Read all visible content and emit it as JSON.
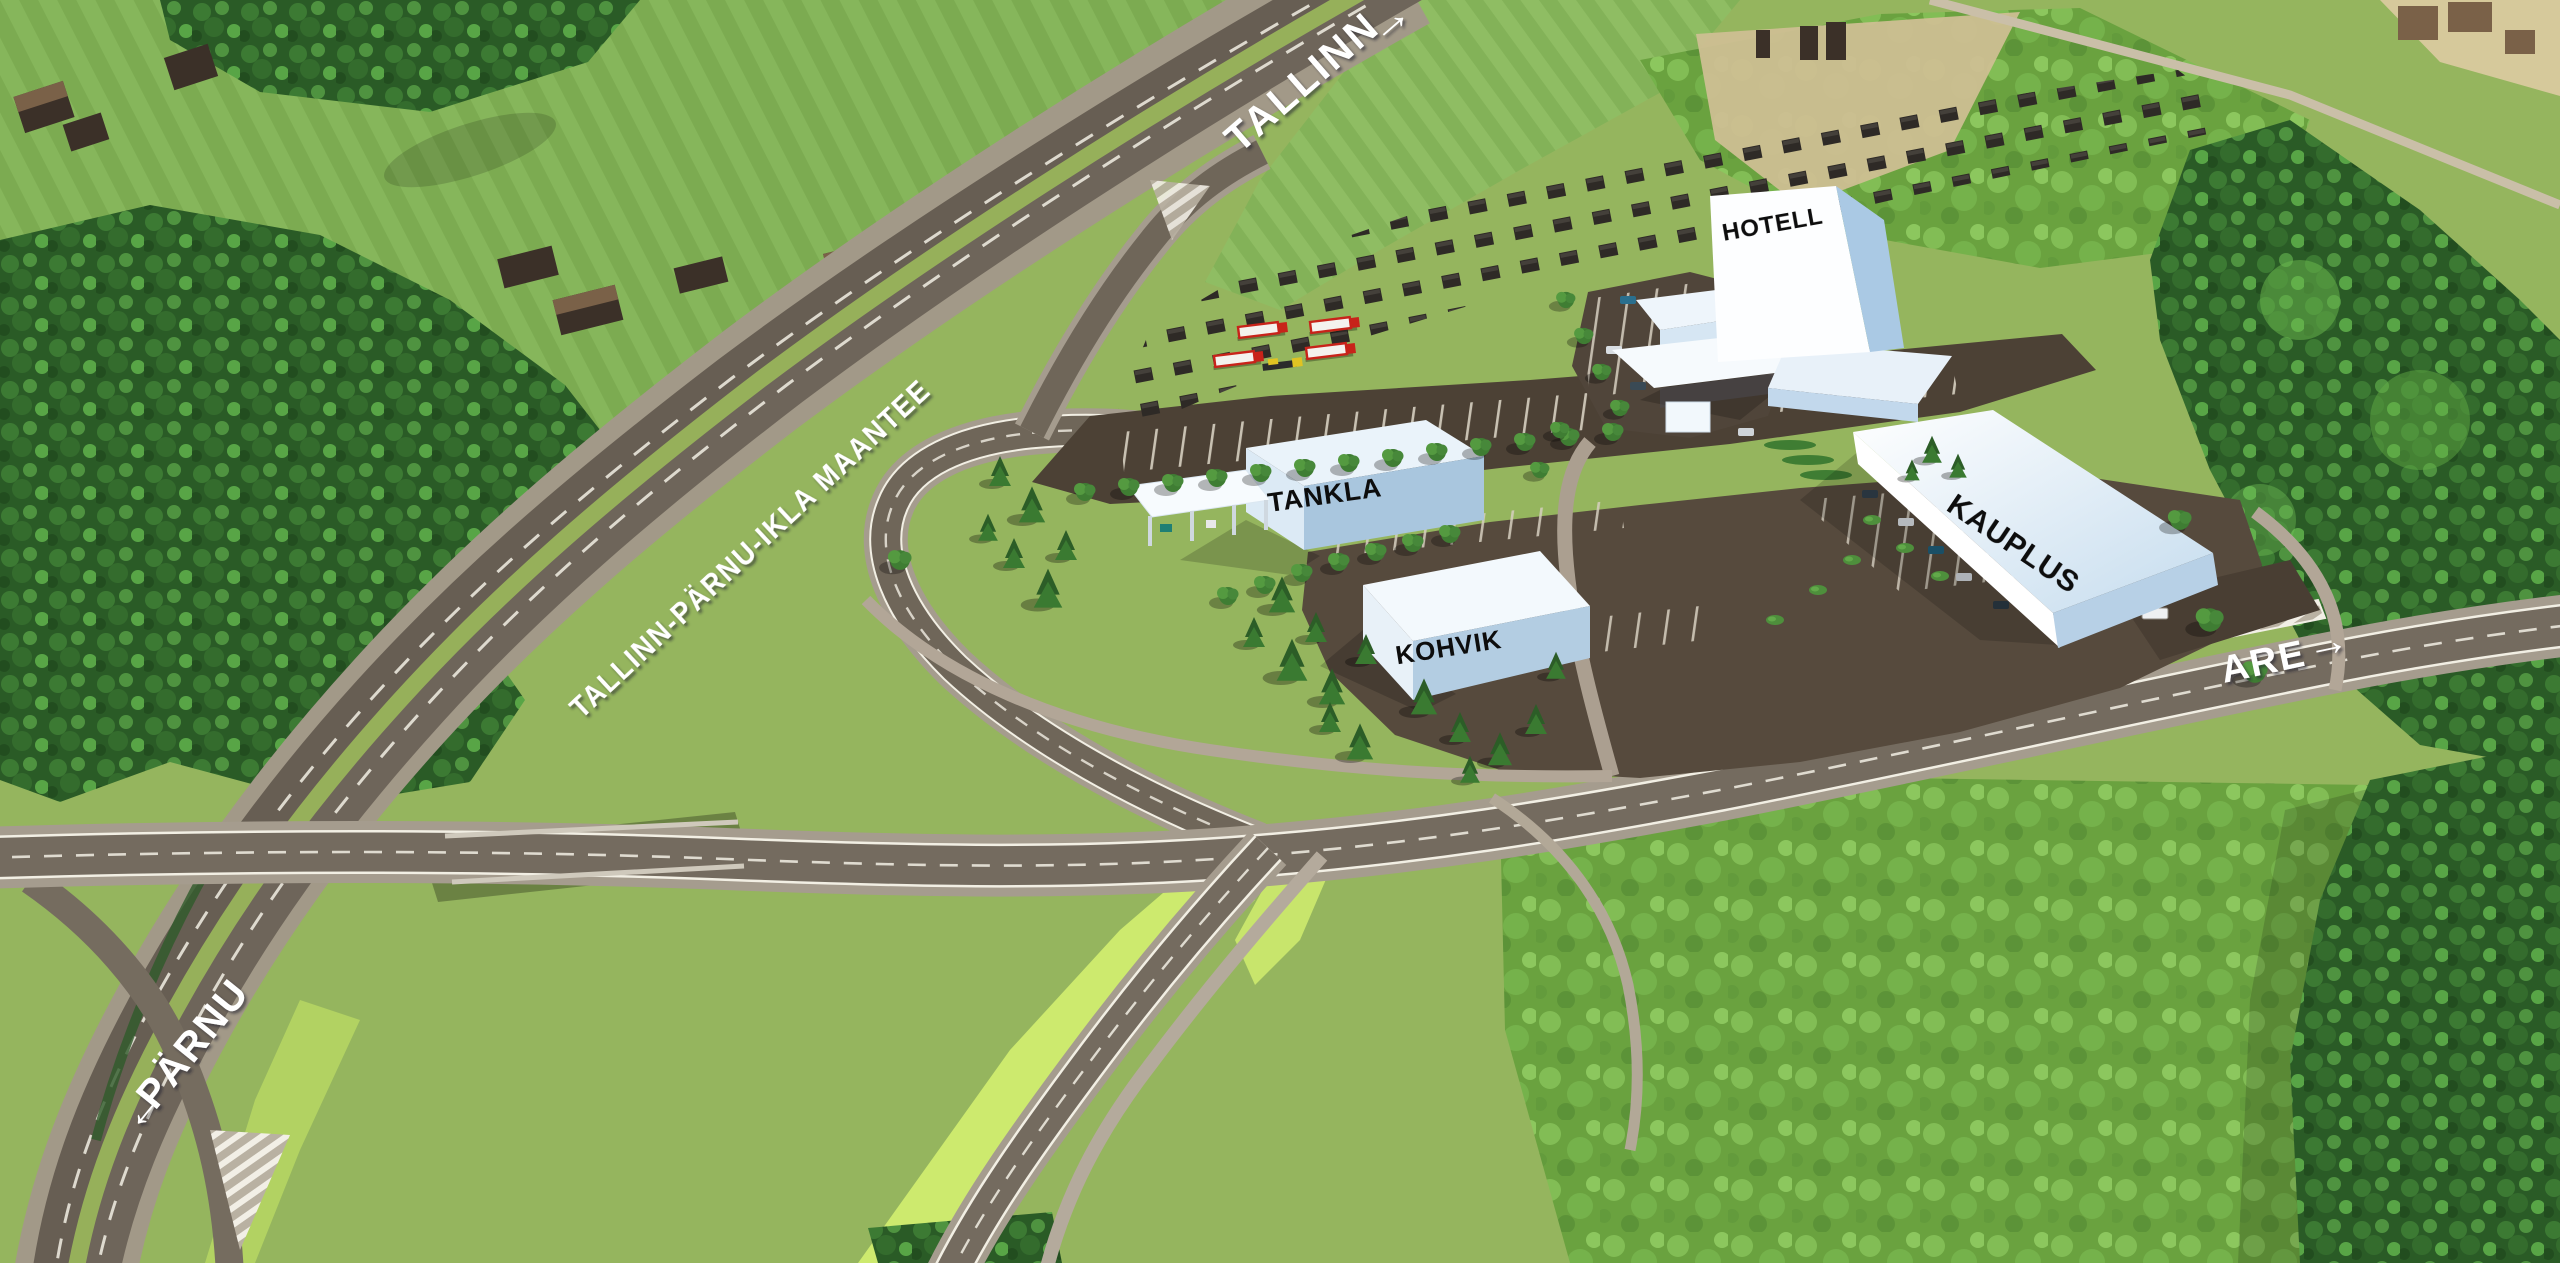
{
  "labels": {
    "highway": "TALLINN-PÄRNU-IKLA MAANTEE",
    "dir_tallinn": "TALLINN",
    "dir_parnu": "PÄRNU",
    "dir_are": "ARE",
    "arrow_right": "→",
    "arrow_left": "←"
  },
  "buildings": {
    "hotell": "HOTELL",
    "tankla": "TANKLA",
    "kohvik": "KOHVIK",
    "kauplus": "KAUPLUS"
  },
  "colors": {
    "field_green": "#7fae53",
    "smooth_grass": "#95b55e",
    "bright_grass": "#cdea6e",
    "forest_dark": "#2d6127",
    "forest_light": "#57a344",
    "road_asphalt": "#6b6257",
    "road_shoulder": "#a89f92",
    "site_asphalt": "#4e4337",
    "parking_asphalt": "#564a3d",
    "building_white": "#ffffff",
    "building_shade": "#a9c6de",
    "truck_red": "#c8231a",
    "label_white": "#ffffff",
    "label_black": "#111111",
    "tan_field": "#cfc196"
  }
}
